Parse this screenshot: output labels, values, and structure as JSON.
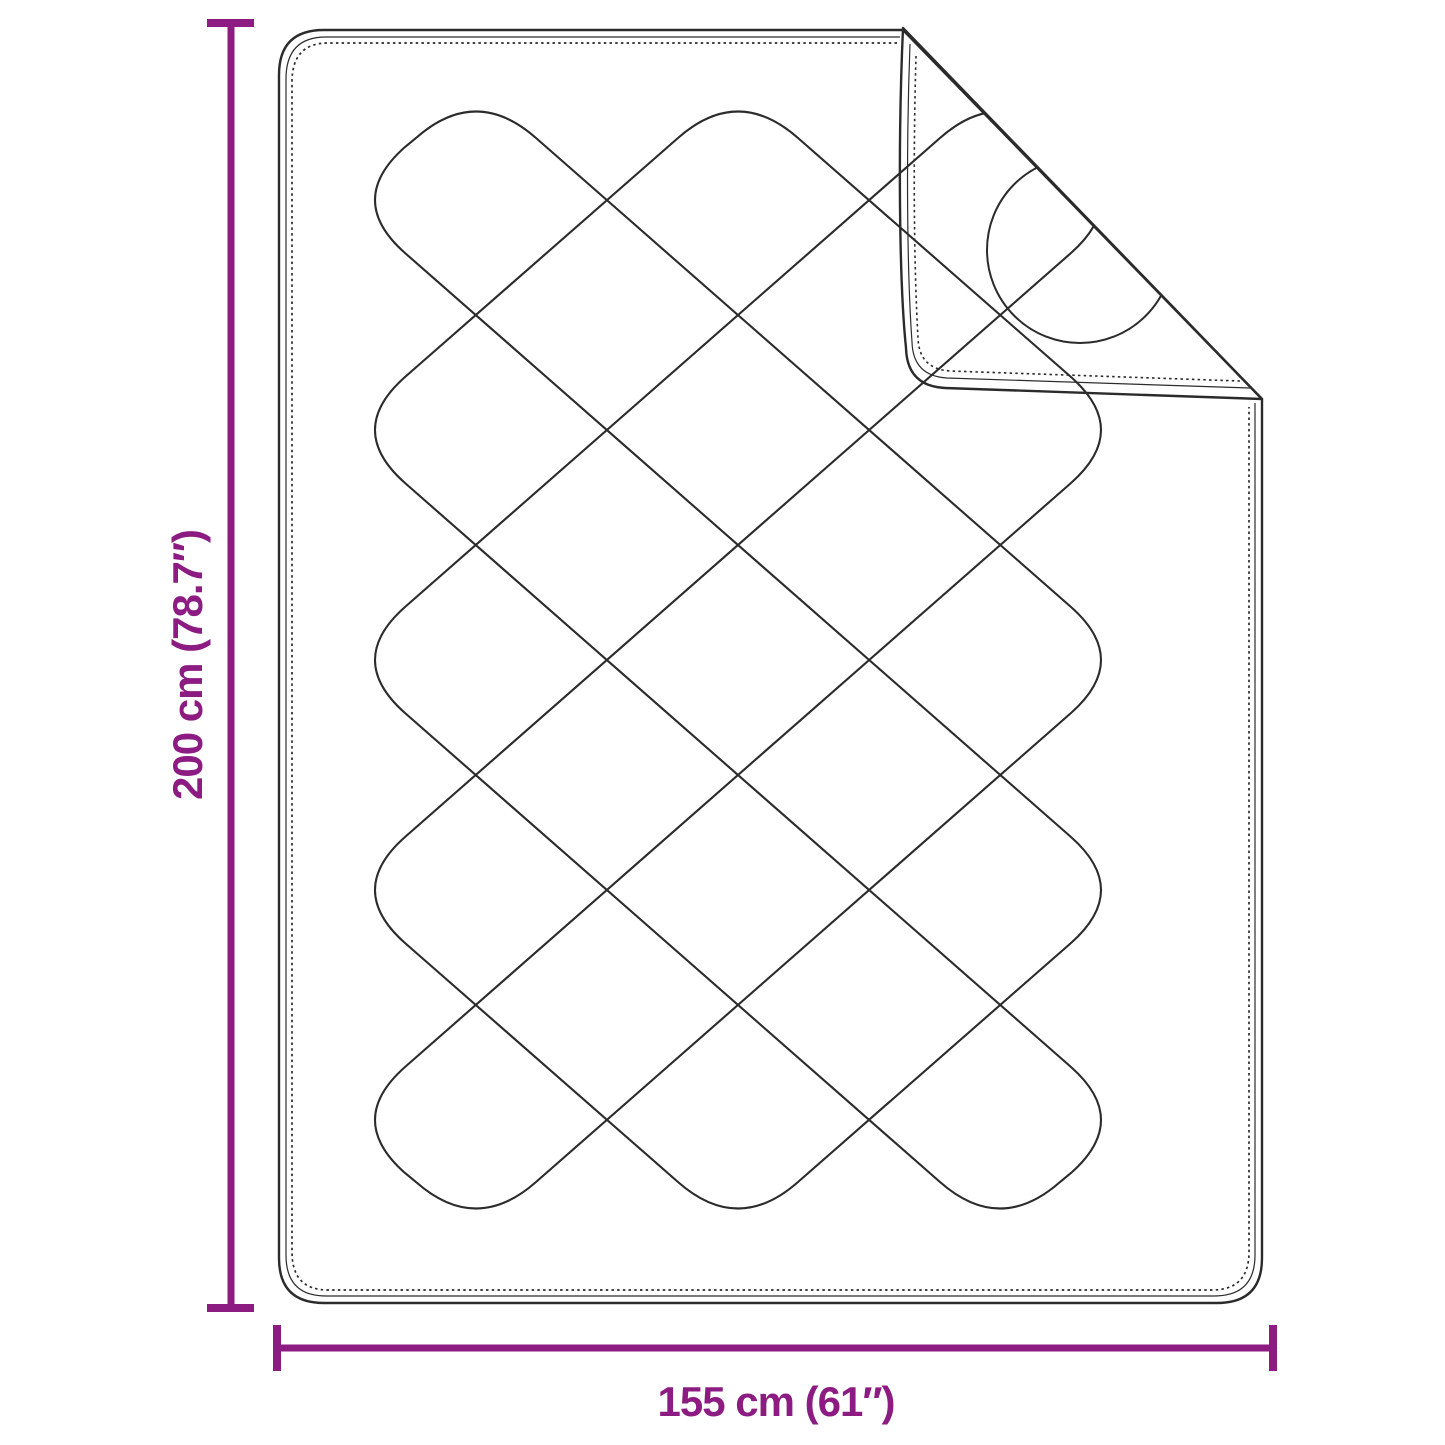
{
  "diagram": {
    "dimensions": {
      "height_label": "200 cm (78.7″)",
      "width_label": "155 cm (61″)"
    },
    "colors": {
      "background": "#ffffff",
      "outline": "#2b2b2b",
      "accent": "#8C1C82"
    }
  }
}
